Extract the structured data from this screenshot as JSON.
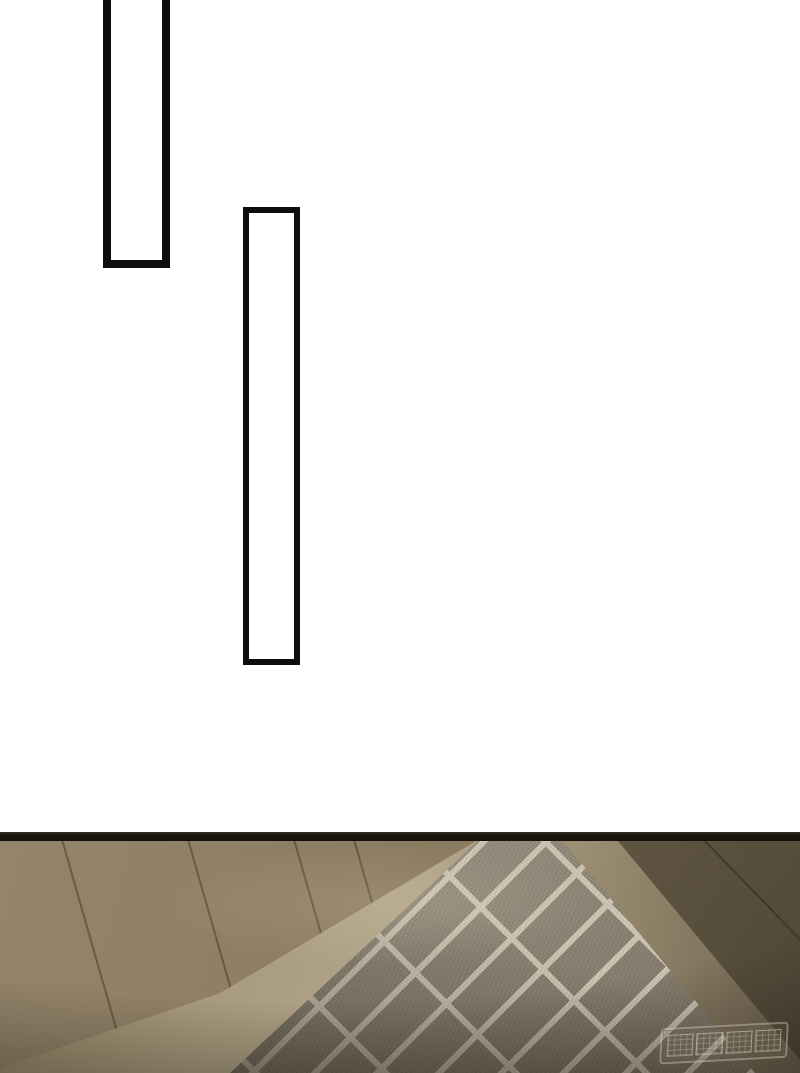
{
  "page": {
    "kind": "webtoon-strip-segment",
    "visible_text": []
  },
  "watermark": {
    "text": "嘟嘟动漫",
    "style": "embossed outlined box, semi-transparent, bottom-right of photo panel"
  },
  "theme": {
    "page-bg": "#ffffff",
    "frame-border": "#0e0d0b",
    "band": "#1a1510",
    "wall": "#8c7c61",
    "wall-light": "#94846b",
    "wall-dark": "#77674d",
    "wall-right": "#6b5e48",
    "baseboard": "#b2a589",
    "brick": "#948b7b",
    "grout": "#d4ccba",
    "shadow": "#211c14",
    "watermark-ink": "#d8d0bc"
  }
}
